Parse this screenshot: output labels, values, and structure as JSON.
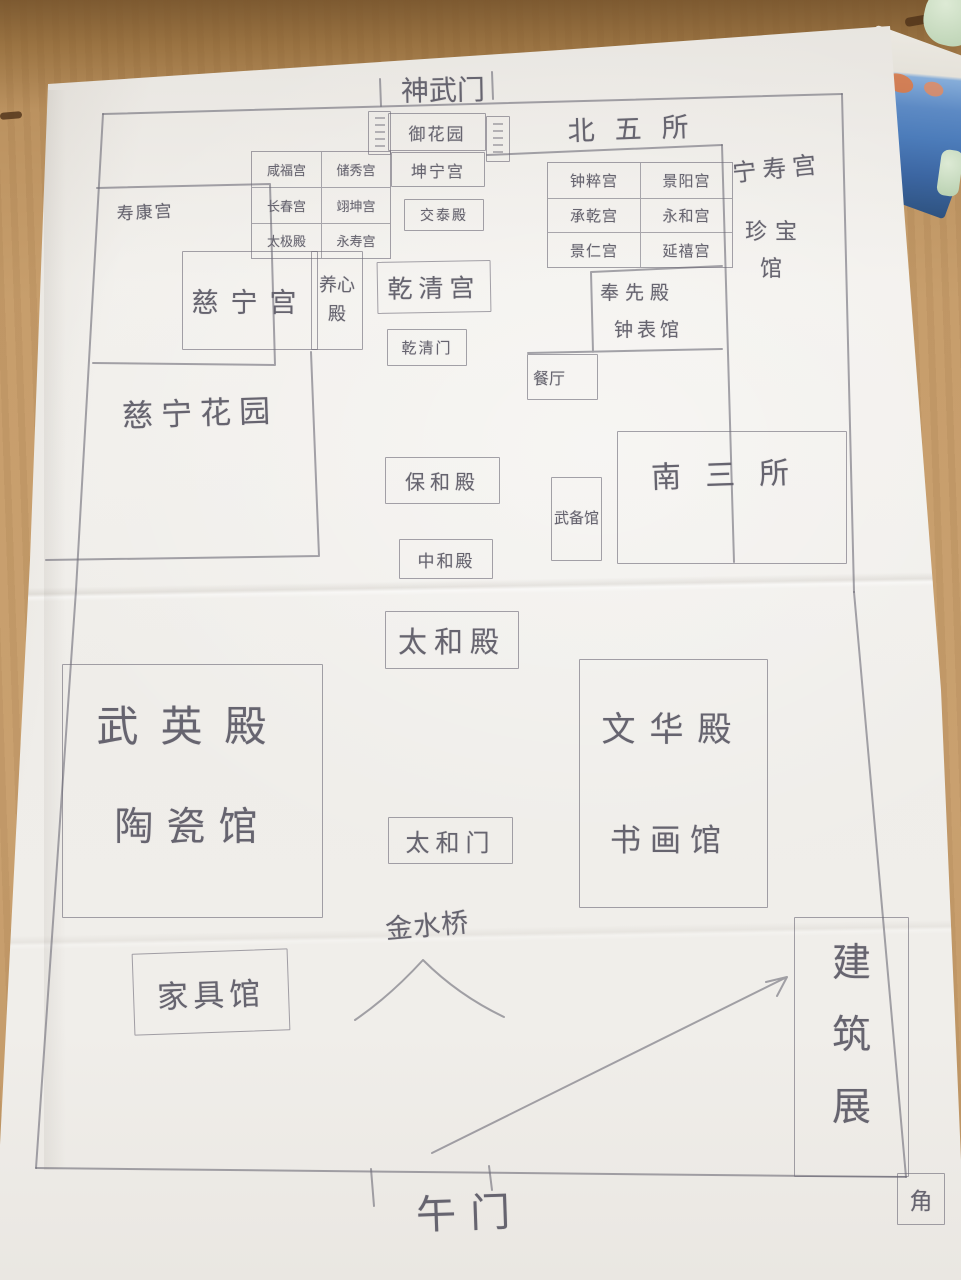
{
  "colors": {
    "pencil": "#6f6d79",
    "paper": "#efede9",
    "table_wood": "#c79e6c",
    "box_blue": "#4c7cba",
    "object_green": "#cfdfc6"
  },
  "palaces": {
    "west": [
      "咸福宫",
      "储秀宫",
      "长春宫",
      "翊坤宫",
      "太极殿",
      "永寿宫"
    ],
    "east": [
      "钟粹宫",
      "景阳宫",
      "承乾宫",
      "永和宫",
      "景仁宫",
      "延禧宫"
    ]
  },
  "labels": {
    "shenwumen": "神武门",
    "yuhuayuan": "御花园",
    "kunninggong": "坤宁宫",
    "beiwusuo": "北五所",
    "jiaotaidian": "交泰殿",
    "qianqinggong": "乾清宫",
    "qianqingmen": "乾清门",
    "shoukanggong": "寿康宫",
    "cininggong": "慈宁宫",
    "yangxindian": "养心殿",
    "ningshougong": "宁寿宫",
    "zhenbaoguan": "珍宝馆",
    "fengxiandian": "奉先殿",
    "zhongbiaoguan": "钟表馆",
    "canting": "餐厅",
    "cininghuayuan": "慈宁花园",
    "baohedian": "保和殿",
    "wubeiguan": "武备馆",
    "nansansuo": "南三所",
    "zhonghedian": "中和殿",
    "taihedian": "太和殿",
    "wuyingdian": "武英殿",
    "taociguan": "陶瓷馆",
    "wenhuadian": "文华殿",
    "shuhuaguan": "书画馆",
    "taihemen": "太和门",
    "jinshuiqiao": "金水桥",
    "jiajuguan": "家具馆",
    "jianzhuzhan": "建筑展",
    "wumen": "午门",
    "jiaolou": "角"
  }
}
